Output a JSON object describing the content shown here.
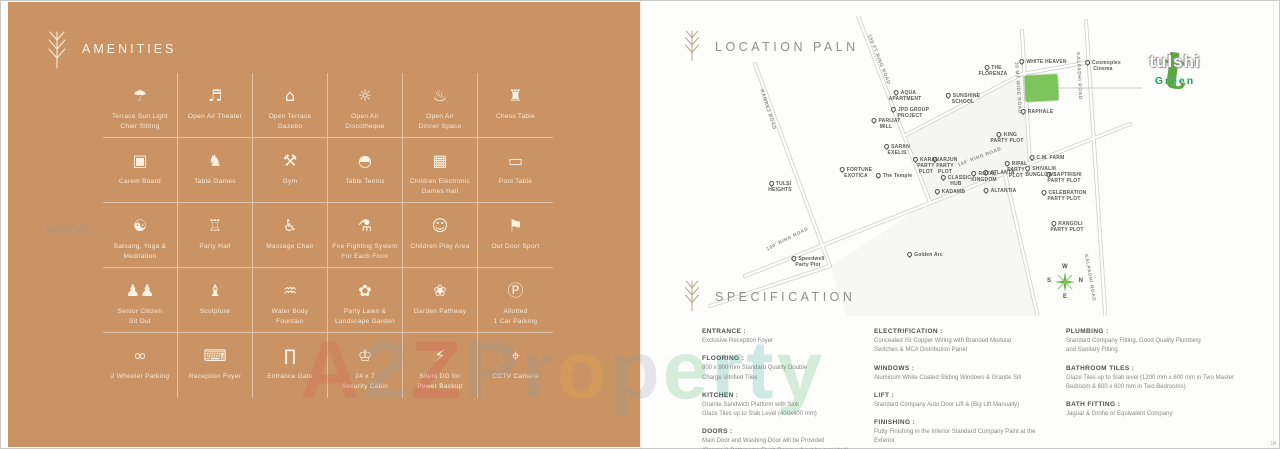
{
  "page_number": "14",
  "watermark": {
    "small": "www.",
    "big_letters": [
      {
        "ch": "A",
        "color": "#e05353"
      },
      {
        "ch": "2",
        "color": "#97a2ad"
      },
      {
        "ch": "Z",
        "color": "#e04b4b"
      },
      {
        "ch": "P",
        "color": "#8d99a9"
      },
      {
        "ch": "r",
        "color": "#8d99a9"
      },
      {
        "ch": "o",
        "color": "#f2b13e"
      },
      {
        "ch": "p",
        "color": "#8d99a9"
      },
      {
        "ch": "e",
        "color": "#43b469"
      },
      {
        "ch": "r",
        "color": "#2f9f90"
      },
      {
        "ch": "t",
        "color": "#2f9f90"
      },
      {
        "ch": "y",
        "color": "#49b163"
      }
    ]
  },
  "amenities": {
    "title": "AMENITIES",
    "items": [
      {
        "icon": "terrace-sitting-icon",
        "glyph": "☂",
        "label": "Terrace Sun Light\nChair Sitting"
      },
      {
        "icon": "open-air-theater-icon",
        "glyph": "♬",
        "label": "Open Air Theater"
      },
      {
        "icon": "gazebo-icon",
        "glyph": "⌂",
        "label": "Open Terrace\nGazebo"
      },
      {
        "icon": "discotheque-icon",
        "glyph": "☼",
        "label": "Open Air\nDiscotheque"
      },
      {
        "icon": "dinner-space-icon",
        "glyph": "♨",
        "label": "Open Air\nDinner Space"
      },
      {
        "icon": "chess-table-icon",
        "glyph": "♜",
        "label": "Chess Table"
      },
      {
        "icon": "carrom-board-icon",
        "glyph": "▣",
        "label": "Carem Board"
      },
      {
        "icon": "table-games-icon",
        "glyph": "♞",
        "label": "Table Games"
      },
      {
        "icon": "gym-icon",
        "glyph": "⚒",
        "label": "Gym"
      },
      {
        "icon": "table-tennis-icon",
        "glyph": "◓",
        "label": "Table Tennis"
      },
      {
        "icon": "games-hall-icon",
        "glyph": "▦",
        "label": "Children Electronic\nGames Hall"
      },
      {
        "icon": "pool-table-icon",
        "glyph": "▭",
        "label": "Pool Table"
      },
      {
        "icon": "yoga-meditation-icon",
        "glyph": "☯",
        "label": "Satsang, Yoga &\nMeditation"
      },
      {
        "icon": "party-hall-icon",
        "glyph": "♖",
        "label": "Party Hall"
      },
      {
        "icon": "massage-chair-icon",
        "glyph": "♿",
        "label": "Massage Chair"
      },
      {
        "icon": "fire-system-icon",
        "glyph": "⚗",
        "label": "Fire Fighting System\nFor Each Floor"
      },
      {
        "icon": "children-play-icon",
        "glyph": "☺",
        "label": "Children Play Area"
      },
      {
        "icon": "outdoor-sport-icon",
        "glyph": "⚑",
        "label": "Out Door Sport"
      },
      {
        "icon": "senior-citizen-icon",
        "glyph": "♟♟",
        "label": "Senior Citizen\nSit Out"
      },
      {
        "icon": "sculpture-icon",
        "glyph": "♝",
        "label": "Sculpture"
      },
      {
        "icon": "fountain-icon",
        "glyph": "♒",
        "label": "Water Body\nFountain"
      },
      {
        "icon": "lawn-garden-icon",
        "glyph": "✿",
        "label": "Party Lawn &\nLandscape Garden"
      },
      {
        "icon": "garden-pathway-icon",
        "glyph": "❀",
        "label": "Garden Pathway"
      },
      {
        "icon": "car-parking-icon",
        "glyph": "Ⓟ",
        "label": "Allotted\n1 Car Parking"
      },
      {
        "icon": "two-wheeler-icon",
        "glyph": "∞",
        "label": "2 Wheeler Parking"
      },
      {
        "icon": "reception-foyer-icon",
        "glyph": "⌨",
        "label": "Reception Foyer"
      },
      {
        "icon": "entrance-gate-icon",
        "glyph": "∏",
        "label": "Entrance Gate"
      },
      {
        "icon": "security-cabin-icon",
        "glyph": "♔",
        "label": "24 x 7\nSecurity Cabin"
      },
      {
        "icon": "dg-backup-icon",
        "glyph": "⚡",
        "label": "Silent DG for\nPower Backup"
      },
      {
        "icon": "cctv-camera-icon",
        "glyph": "⌖",
        "label": "CCTV Camera"
      }
    ]
  },
  "map": {
    "title": "LOCATION PALN",
    "logo": {
      "name": "tulshi",
      "sub": "Green"
    },
    "compass": {
      "top": "W",
      "left": "S",
      "right": "N",
      "bottom": "E"
    },
    "pois": [
      {
        "label": "KAMREJ ROAD",
        "x": 77,
        "y": 94,
        "road": true,
        "rotate": 72
      },
      {
        "label": "150 FT RING ROAD",
        "x": 188,
        "y": 44,
        "road": true,
        "rotate": 68
      },
      {
        "label": "AQUA\nAPARTMENT",
        "x": 215,
        "y": 80,
        "pin": true
      },
      {
        "label": "SUNSHINE\nSCHOOL",
        "x": 273,
        "y": 83,
        "pin": true
      },
      {
        "label": "JPD GROUP\nPROJECT",
        "x": 220,
        "y": 97,
        "pin": true
      },
      {
        "label": "PARIJAT\nMILL",
        "x": 196,
        "y": 108,
        "pin": true
      },
      {
        "label": "SARAN\nEXELIS",
        "x": 207,
        "y": 134,
        "pin": true
      },
      {
        "label": "THE\nFLORENZA",
        "x": 303,
        "y": 55,
        "pin": true
      },
      {
        "label": "WHITE HEAVEN",
        "x": 353,
        "y": 46,
        "pin": true
      },
      {
        "label": "Cosmoplex\nCinema",
        "x": 413,
        "y": 50,
        "pin": true
      },
      {
        "label": "30 MT WIDE ROAD",
        "x": 327,
        "y": 72,
        "road": true,
        "rotate": 86
      },
      {
        "label": "KALPADHI ROAD",
        "x": 388,
        "y": 60,
        "road": true,
        "rotate": 87
      },
      {
        "label": "KALPADHI ROAD",
        "x": 399,
        "y": 262,
        "road": true,
        "rotate": 80
      },
      {
        "label": "RAPHALE",
        "x": 347,
        "y": 96,
        "pin": true
      },
      {
        "label": "KING\nPARTY PLOT",
        "x": 317,
        "y": 122,
        "pin": true
      },
      {
        "label": "C.M. FARM",
        "x": 357,
        "y": 142,
        "pin": true
      },
      {
        "label": "TULSI\nHEIGHTS",
        "x": 90,
        "y": 171,
        "pin": true
      },
      {
        "label": "FORTUNE\nEXOTICA",
        "x": 166,
        "y": 157,
        "pin": true
      },
      {
        "label": "The Temple",
        "x": 204,
        "y": 160,
        "pin": true
      },
      {
        "label": "KARAN\nPARTY\nPLOT",
        "x": 236,
        "y": 150,
        "pin": true
      },
      {
        "label": "ARJUN\nPARTY\nPLOT",
        "x": 255,
        "y": 150,
        "pin": true
      },
      {
        "label": "150' RING ROAD",
        "x": 290,
        "y": 142,
        "road": true,
        "rotate": -21
      },
      {
        "label": "CLASSIC\nHUB",
        "x": 266,
        "y": 165,
        "pin": true
      },
      {
        "label": "ROYAL\nKINGDOM",
        "x": 294,
        "y": 161,
        "pin": true
      },
      {
        "label": "ATLANTA",
        "x": 309,
        "y": 157,
        "pin": true
      },
      {
        "label": "RIPAL\nPARTY\nPLOT",
        "x": 326,
        "y": 154,
        "pin": true
      },
      {
        "label": "SHIVALIK\nBUNGLOWS",
        "x": 351,
        "y": 156,
        "pin": true
      },
      {
        "label": "SAPTRISHI\nPARTY PLOT",
        "x": 374,
        "y": 162,
        "pin": true
      },
      {
        "label": "KADAMB",
        "x": 260,
        "y": 176,
        "pin": true
      },
      {
        "label": "ALTANTIA",
        "x": 310,
        "y": 175,
        "pin": true
      },
      {
        "label": "CELEBRATION\nPARTY PLOT",
        "x": 374,
        "y": 180,
        "pin": true
      },
      {
        "label": "RANGOLI\nPARTY PLOT",
        "x": 377,
        "y": 211,
        "pin": true
      },
      {
        "label": "Golden Arc",
        "x": 235,
        "y": 239,
        "pin": true
      },
      {
        "label": "100' RING ROAD",
        "x": 98,
        "y": 224,
        "road": true,
        "rotate": -27
      },
      {
        "label": "Speedwell\nParty Plot",
        "x": 118,
        "y": 246,
        "pin": true
      }
    ]
  },
  "specification": {
    "title": "SPECIFICATION",
    "columns": [
      [
        {
          "title": "ENTRANCE :",
          "body": "Exclusive Reception Foyer"
        },
        {
          "title": "FLOORING :",
          "body": "800 x 800 mm Standard Quality Double\nCharge Vitrified Tiles"
        },
        {
          "title": "KITCHEN :",
          "body": "Granite Sandwich Platform with Sink\nGlaze Tiles up to Slab Level (400x400 mm)"
        },
        {
          "title": "DOORS :",
          "body": "Main Door and Washing Door will be Provided\n(Rooms & Bathrooms Flush Doors will not be provided)"
        }
      ],
      [
        {
          "title": "ELECTRIFICATION :",
          "body": "Concealed ISI Copper Wiring with Branded Modular\nSwitches & MCA Distribution Panel"
        },
        {
          "title": "WINDOWS :",
          "body": "Aluminum White Coated Sliding Windows & Granite Sill"
        },
        {
          "title": "LIFT :",
          "body": "Standard Company Auto Door Lift & (Big Lift Manually)"
        },
        {
          "title": "FINISHING :",
          "body": "Putty Finishing in the Interior Standard Company Paint at the Exterior"
        }
      ],
      [
        {
          "title": "PLUMBING :",
          "body": "Standard Company Fitting, Good Quality Plumbing\nand Sanitary Fitting"
        },
        {
          "title": "BATHROOM TILES :",
          "body": "Glaze Tiles up to Slab level (1200 mm x 600 mm in Two Master\nBedroom & 600 x 600 mm in Two Bedrooms)"
        },
        {
          "title": "BATH FITTING :",
          "body": "Jaguar & Grohe or Equivalent Company"
        }
      ]
    ]
  }
}
